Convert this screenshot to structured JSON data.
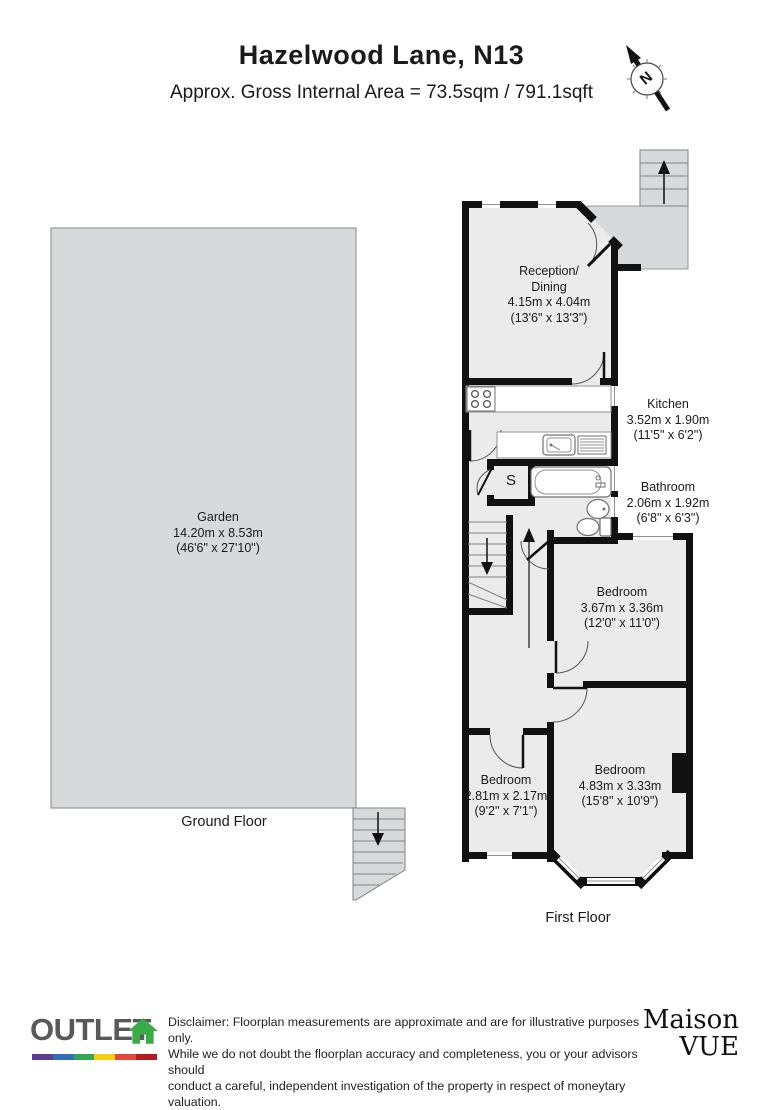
{
  "header": {
    "title": "Hazelwood Lane, N13",
    "subtitle": "Approx. Gross Internal Area = 73.5sqm / 791.1sqft",
    "compass_letter": "N"
  },
  "ground_floor": {
    "floor_label": "Ground Floor",
    "garden": {
      "name": "Garden",
      "metric": "14.20m x 8.53m",
      "imperial": "(46'6\" x 27'10\")"
    }
  },
  "first_floor": {
    "floor_label": "First Floor",
    "rooms": {
      "reception": {
        "name": "Reception/",
        "name2": "Dining",
        "metric": "4.15m x 4.04m",
        "imperial": "(13'6\" x 13'3\")"
      },
      "kitchen": {
        "name": "Kitchen",
        "metric": "3.52m x 1.90m",
        "imperial": "(11'5\" x 6'2\")"
      },
      "bathroom": {
        "name": "Bathroom",
        "metric": "2.06m x 1.92m",
        "imperial": "(6'8\" x 6'3\")"
      },
      "bedroom_middle": {
        "name": "Bedroom",
        "metric": "3.67m x 3.36m",
        "imperial": "(12'0\" x 11'0\")"
      },
      "bedroom_large": {
        "name": "Bedroom",
        "metric": "4.83m x 3.33m",
        "imperial": "(15'8\" x 10'9\")"
      },
      "bedroom_small": {
        "name": "Bedroom",
        "metric": "2.81m x 2.17m",
        "imperial": "(9'2\" x 7'1\")"
      },
      "store": {
        "label": "S"
      }
    }
  },
  "footer": {
    "outlet_logo_text": "OUTLET",
    "disclaimer_lines": [
      "Disclaimer: Floorplan measurements are approximate and are for illustrative purposes only.",
      "While we do not doubt the floorplan accuracy and completeness, you or your advisors should",
      "conduct a careful, independent investigation of the property in respect of moneytary valuation."
    ],
    "maison_line1": "Maison",
    "maison_line2": "VUE"
  },
  "colors": {
    "wall": "#111111",
    "room_fill": "#ebebec",
    "external_fill": "#d8d9da",
    "logo_gray": "#58595b",
    "accent_green": "#3aab47",
    "rainbow": [
      "#5c3d91",
      "#2f6db6",
      "#35a457",
      "#f2d113",
      "#e2483d",
      "#b51c20"
    ]
  }
}
